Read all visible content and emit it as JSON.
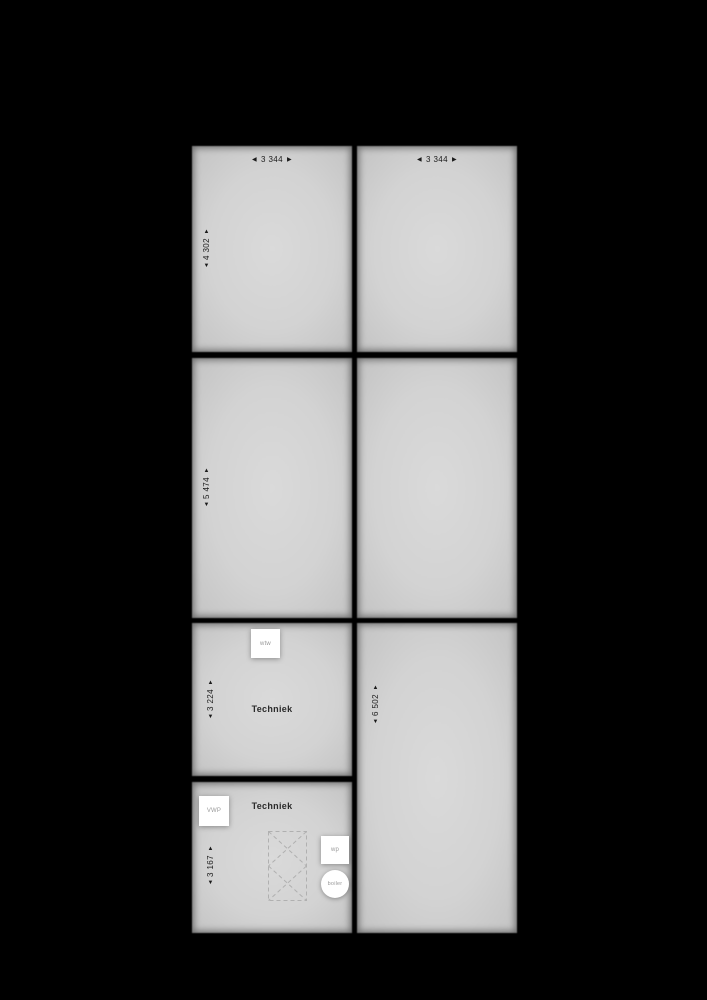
{
  "colors": {
    "background": "#000000",
    "room_fill": "#d3d3d3",
    "dim_text": "#1a1a1a",
    "room_label": "#2b2b2b",
    "equipment_fill": "#ffffff",
    "equipment_text": "#9a9a9a",
    "dashed_line": "#b0b0b0"
  },
  "arrows": {
    "up": "▲",
    "down": "▼",
    "left": "◀",
    "right": "▶"
  },
  "rooms": {
    "top_left": {
      "width_dim": "3 344",
      "height_dim": "4 302"
    },
    "top_right": {
      "width_dim": "3 344"
    },
    "mid_left": {
      "height_dim": "5 474"
    },
    "tech_upper": {
      "height_dim": "3 224",
      "label": "Techniek"
    },
    "right_tall": {
      "height_dim": "6 502"
    },
    "tech_lower": {
      "height_dim": "3 167",
      "label": "Techniek"
    }
  },
  "equipment": {
    "wtw": "wtw",
    "vwp": "VWP",
    "wp": "wp",
    "boiler": "boiler"
  }
}
